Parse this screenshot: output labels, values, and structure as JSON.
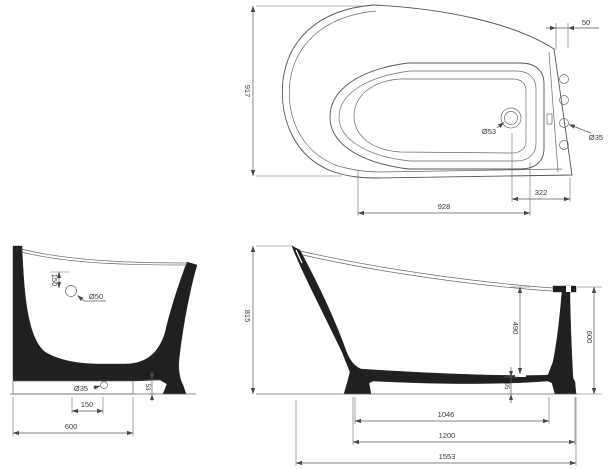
{
  "views": {
    "plan": {
      "width": "917",
      "lip_width": "50",
      "basin_length": "928",
      "end_offset": "322",
      "drain_diameter": "Ø53",
      "overflow_hole_diameter": "Ø35"
    },
    "cross_section": {
      "overflow_drop": "150",
      "overflow_diameter": "Ø50",
      "base_hole_diameter": "Ø35",
      "base_hole_offset": "150",
      "base_width": "600",
      "plinth_height": "53"
    },
    "side_section": {
      "back_height": "815",
      "inner_depth": "490",
      "front_height": "600",
      "bottom_clearance": "95",
      "floor_length": "1046",
      "base_length": "1200",
      "overall_length": "1553"
    }
  },
  "colors": {
    "ink": "#3d3d3f",
    "fill": "#1f1f21",
    "background": "#ffffff"
  }
}
